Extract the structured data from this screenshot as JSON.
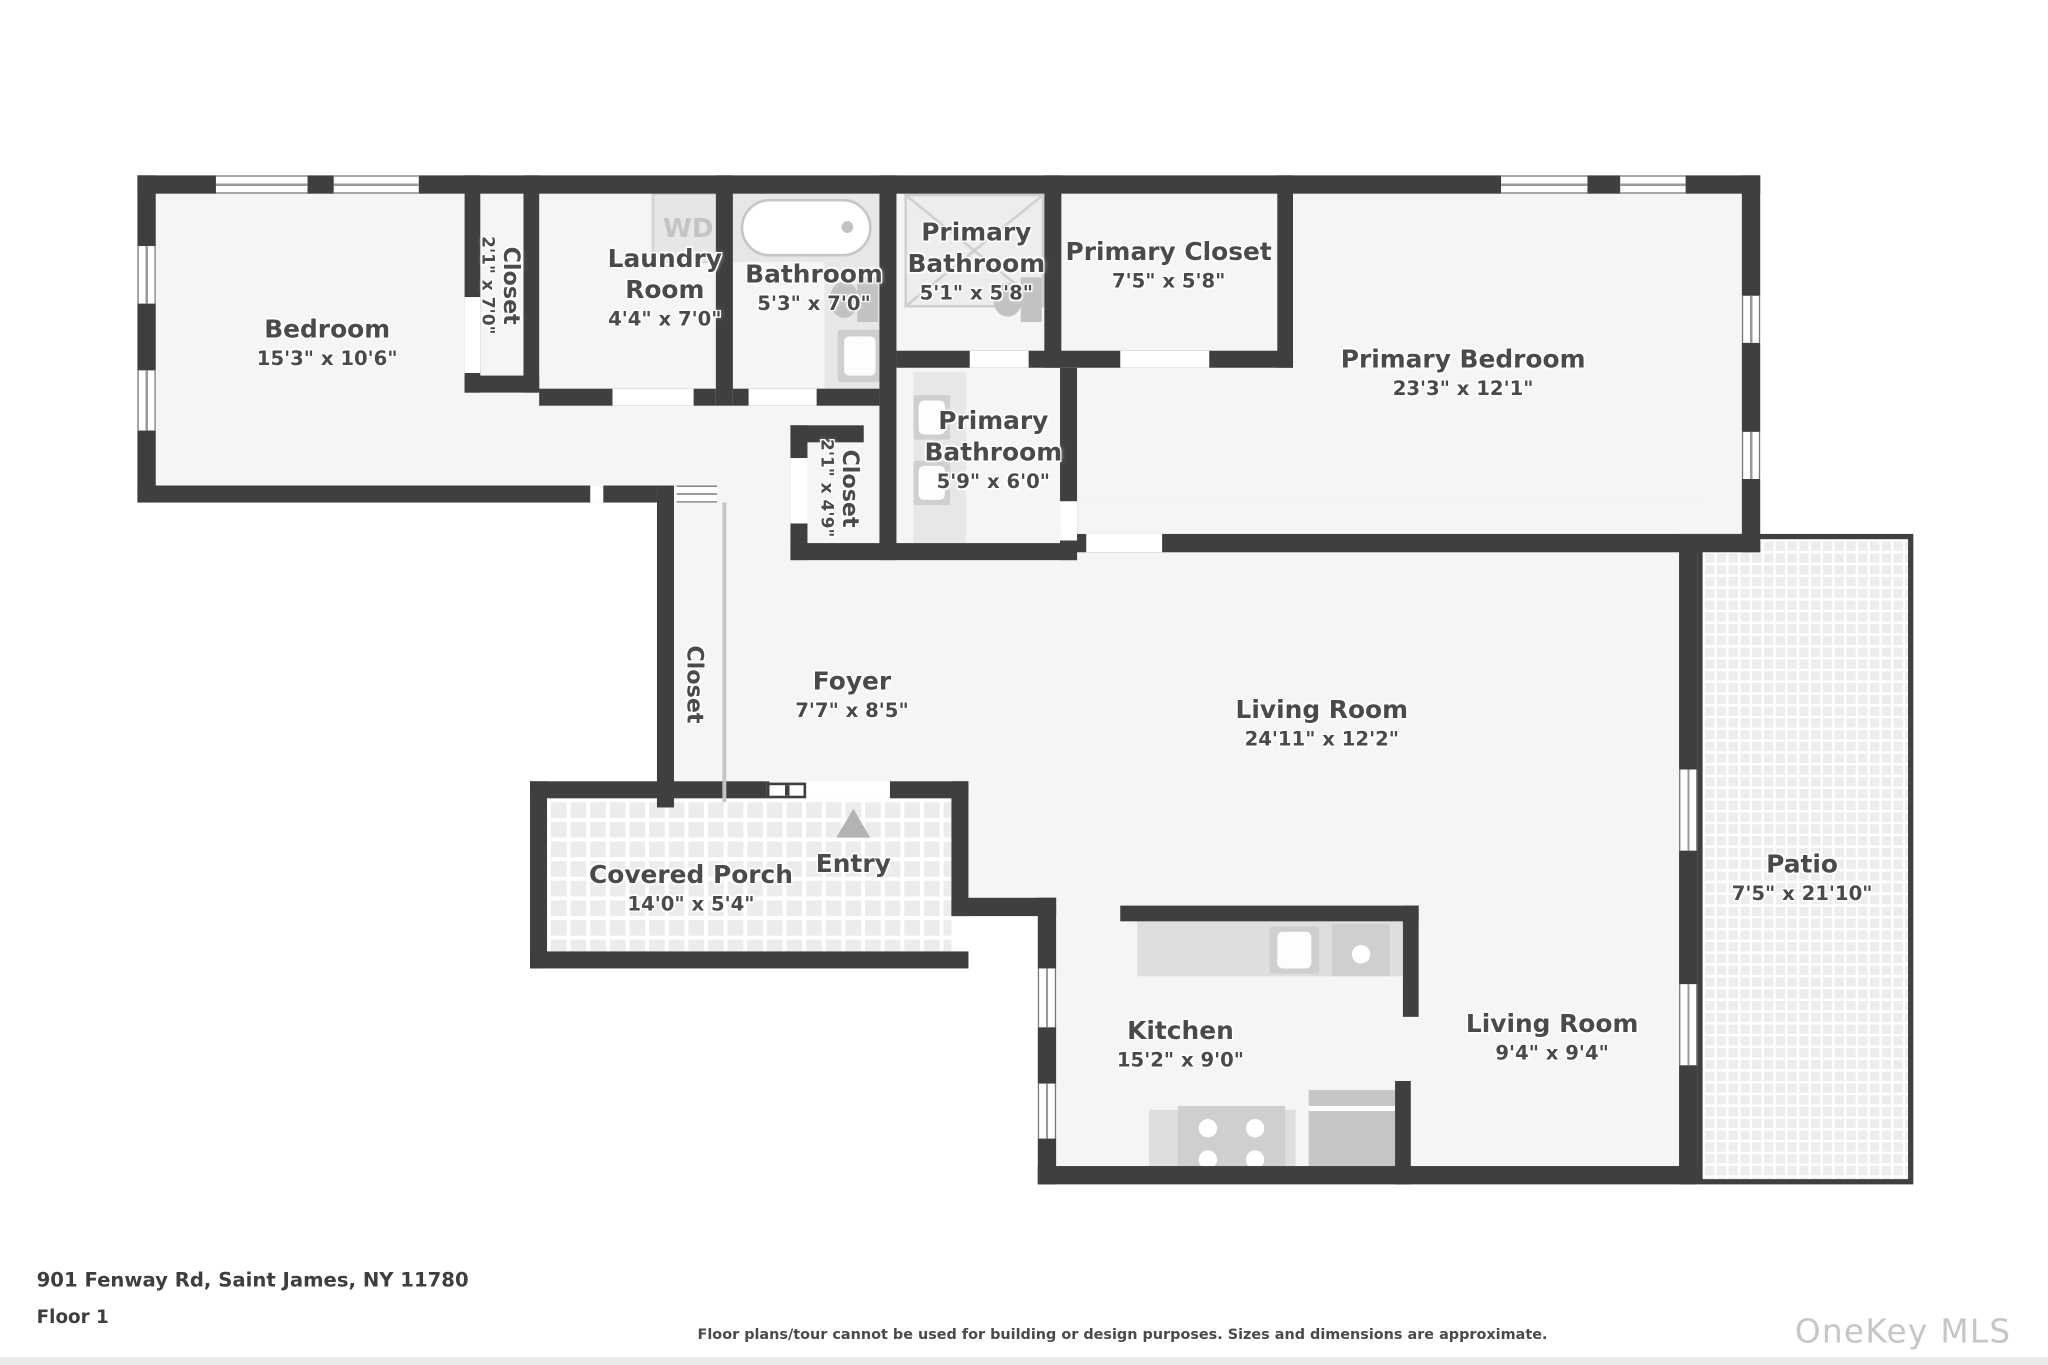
{
  "floorplan": {
    "rooms": {
      "bedroom": {
        "name": "Bedroom",
        "dims": "15'3\" x 10'6\""
      },
      "bedroom_closet": {
        "name": "Closet",
        "dims": "2'1\" x 7'0\""
      },
      "laundry": {
        "name": "Laundry Room",
        "dims": "4'4\" x 7'0\""
      },
      "bathroom": {
        "name": "Bathroom",
        "dims": "5'3\" x 7'0\""
      },
      "primary_bathroom_upper": {
        "name": "Primary Bathroom",
        "dims": "5'1\" x 5'8\""
      },
      "primary_closet": {
        "name": "Primary Closet",
        "dims": "7'5\" x 5'8\""
      },
      "primary_bedroom": {
        "name": "Primary Bedroom",
        "dims": "23'3\" x 12'1\""
      },
      "hall_closet": {
        "name": "Closet",
        "dims": "2'1\" x 4'9\""
      },
      "primary_bathroom_lower": {
        "name": "Primary Bathroom",
        "dims": "5'9\" x 6'0\""
      },
      "foyer_closet": {
        "name": "Closet"
      },
      "foyer": {
        "name": "Foyer",
        "dims": "7'7\" x 8'5\""
      },
      "living_room": {
        "name": "Living Room",
        "dims": "24'11\" x 12'2\""
      },
      "covered_porch": {
        "name": "Covered Porch",
        "dims": "14'0\" x 5'4\""
      },
      "entry": {
        "name": "Entry"
      },
      "kitchen": {
        "name": "Kitchen",
        "dims": "15'2\" x 9'0\""
      },
      "living_room_2": {
        "name": "Living Room",
        "dims": "9'4\" x 9'4\""
      },
      "patio": {
        "name": "Patio",
        "dims": "7'5\" x 21'10\""
      }
    },
    "fixtures": {
      "washer_dryer": "WD"
    },
    "colors": {
      "wall": "#3f3f3f",
      "floor": "#f5f5f5",
      "fixture": "#cfcfcf",
      "label": "#4a4a4a",
      "watermark": "#c6c6c6"
    }
  },
  "footer": {
    "address": "901 Fenway Rd, Saint James, NY 11780",
    "floor_label": "Floor 1",
    "disclaimer": "Floor plans/tour cannot be used for building or design purposes. Sizes and dimensions are approximate.",
    "watermark": "OneKey MLS"
  }
}
